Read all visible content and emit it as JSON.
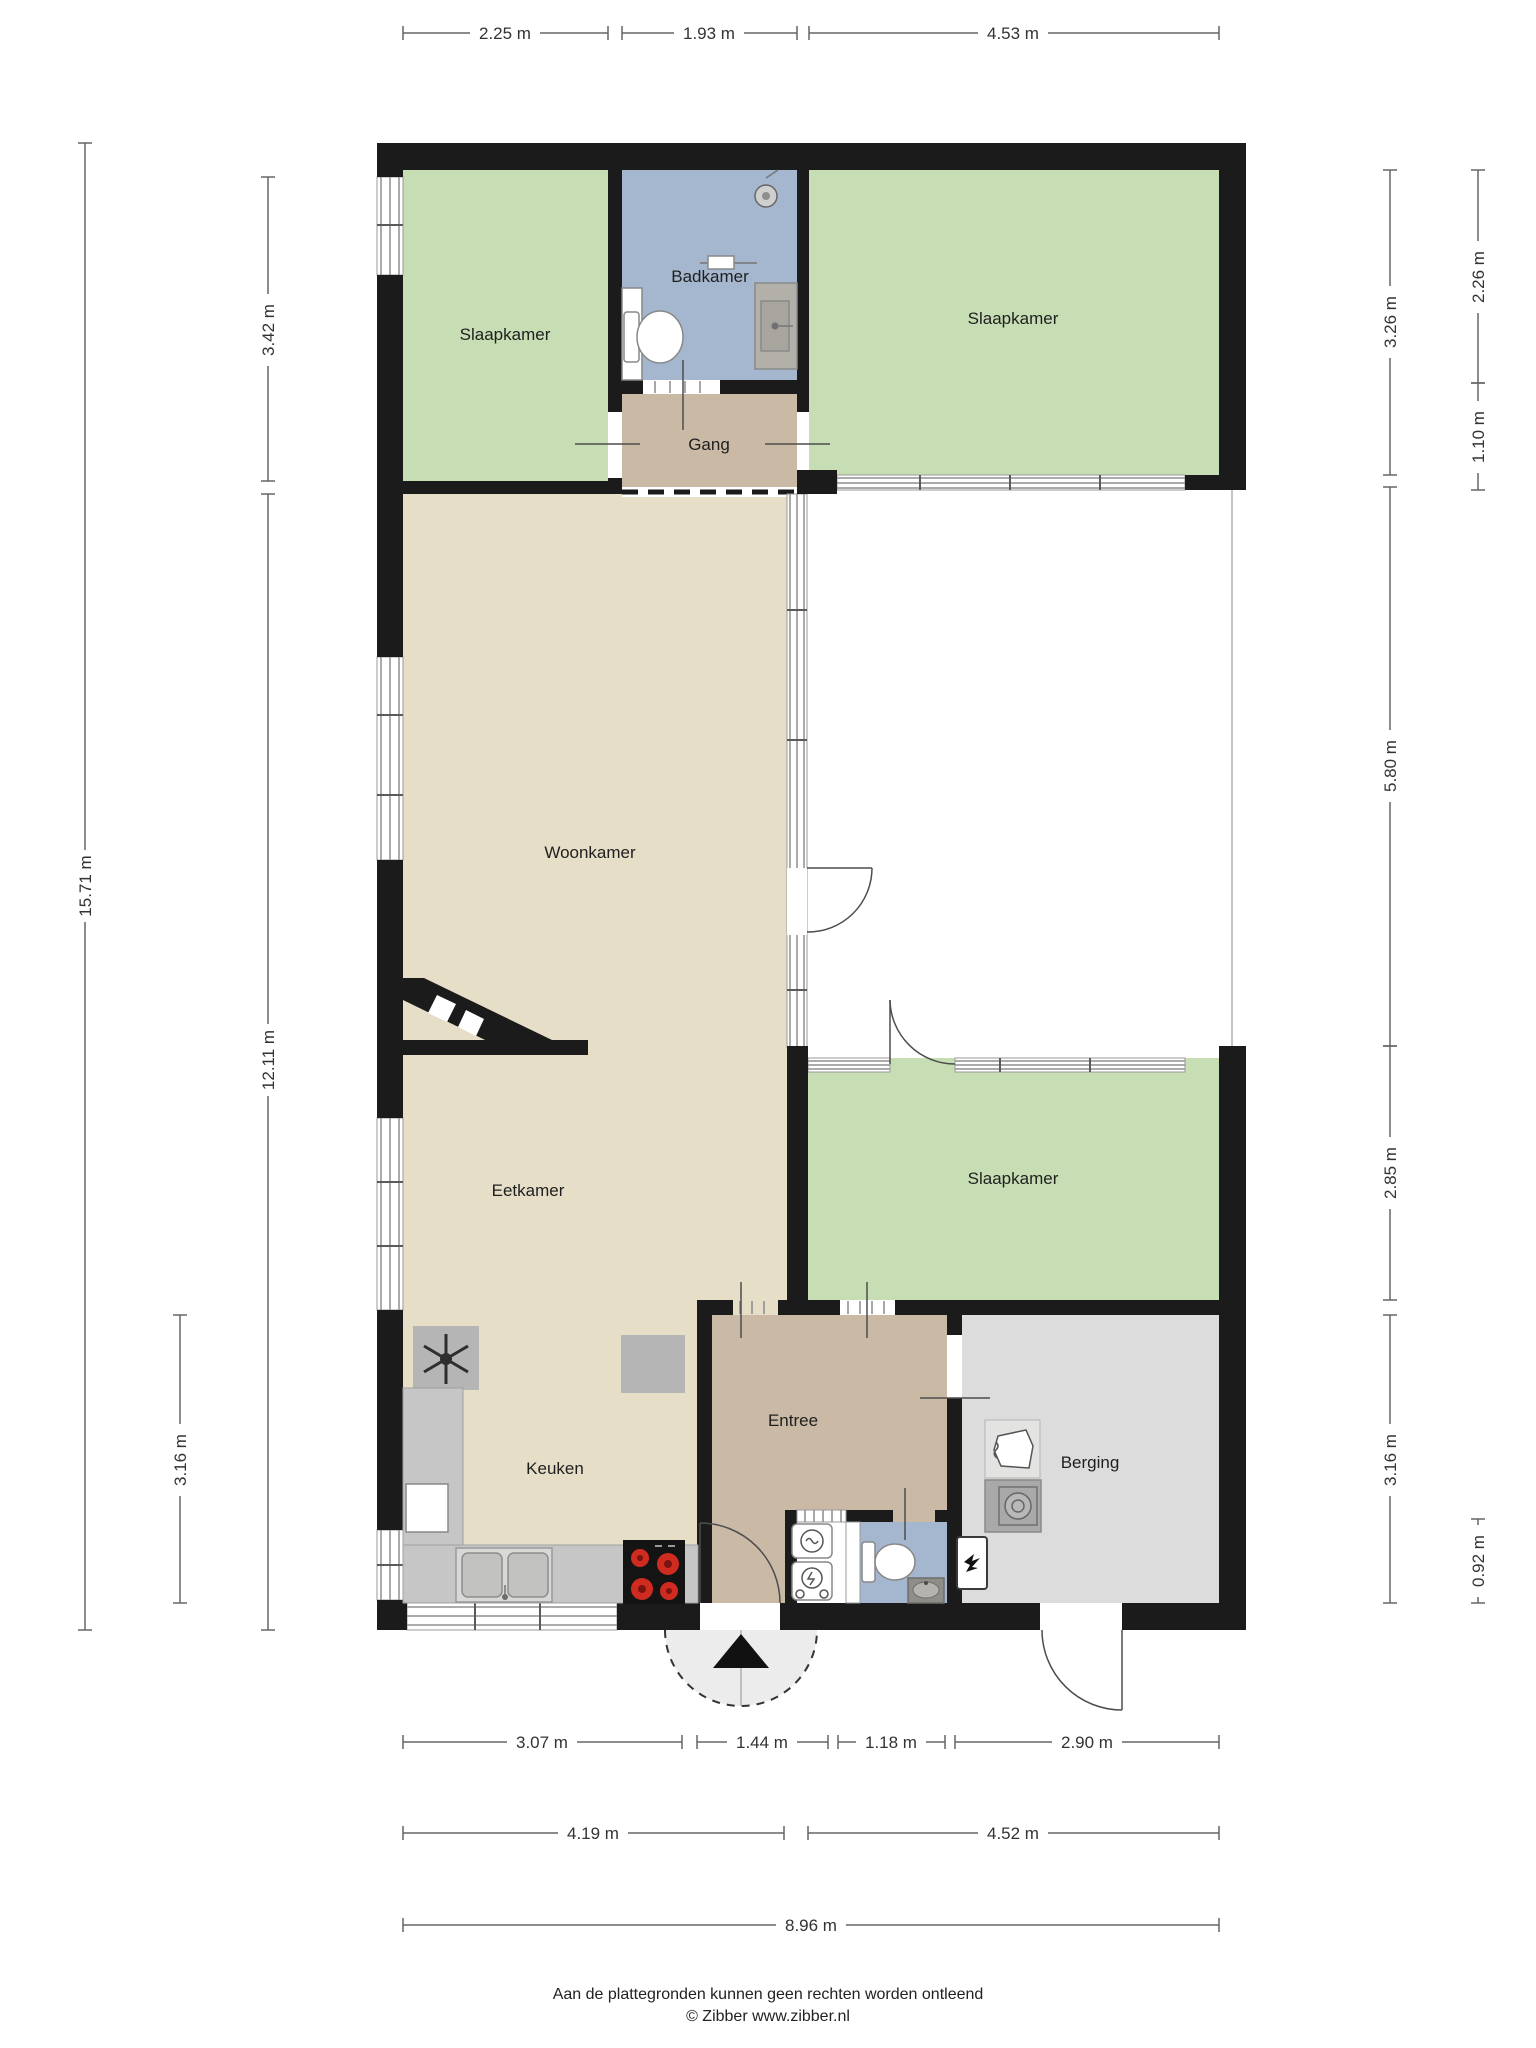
{
  "colors": {
    "wall": "#1b1b1b",
    "room_green": "#c7deb4",
    "room_blue": "#a4b7ce",
    "room_tan": "#cabaa5",
    "room_cream": "#e6dec7",
    "room_gray": "#dcdcdc",
    "burner_red": "#cf2b20"
  },
  "rooms": {
    "slaapkamer_tl": {
      "label": "Slaapkamer"
    },
    "badkamer": {
      "label": "Badkamer"
    },
    "slaapkamer_tr": {
      "label": "Slaapkamer"
    },
    "gang": {
      "label": "Gang"
    },
    "woonkamer": {
      "label": "Woonkamer"
    },
    "eetkamer": {
      "label": "Eetkamer"
    },
    "slaapkamer_br": {
      "label": "Slaapkamer"
    },
    "keuken": {
      "label": "Keuken"
    },
    "entree": {
      "label": "Entree"
    },
    "berging": {
      "label": "Berging"
    }
  },
  "dimensions": {
    "top": [
      {
        "label": "2.25 m"
      },
      {
        "label": "1.93 m"
      },
      {
        "label": "4.53 m"
      }
    ],
    "left": [
      {
        "label": "15.71 m"
      },
      {
        "label": "3.42 m"
      },
      {
        "label": "12.11 m"
      },
      {
        "label": "3.16 m"
      }
    ],
    "right_inner": [
      {
        "label": "3.26 m"
      },
      {
        "label": "5.80 m"
      },
      {
        "label": "2.85 m"
      },
      {
        "label": "3.16 m"
      }
    ],
    "right_outer": [
      {
        "label": "2.26 m"
      },
      {
        "label": "1.10 m"
      },
      {
        "label": "0.92 m"
      }
    ],
    "bottom_row1": [
      {
        "label": "3.07 m"
      },
      {
        "label": "1.44 m"
      },
      {
        "label": "1.18 m"
      },
      {
        "label": "2.90 m"
      }
    ],
    "bottom_row2": [
      {
        "label": "4.19 m"
      },
      {
        "label": "4.52 m"
      }
    ],
    "bottom_row3": [
      {
        "label": "8.96 m"
      }
    ]
  },
  "footer": {
    "disclaimer": "Aan de plattegronden kunnen geen rechten worden ontleend",
    "credit": "© Zibber www.zibber.nl"
  }
}
